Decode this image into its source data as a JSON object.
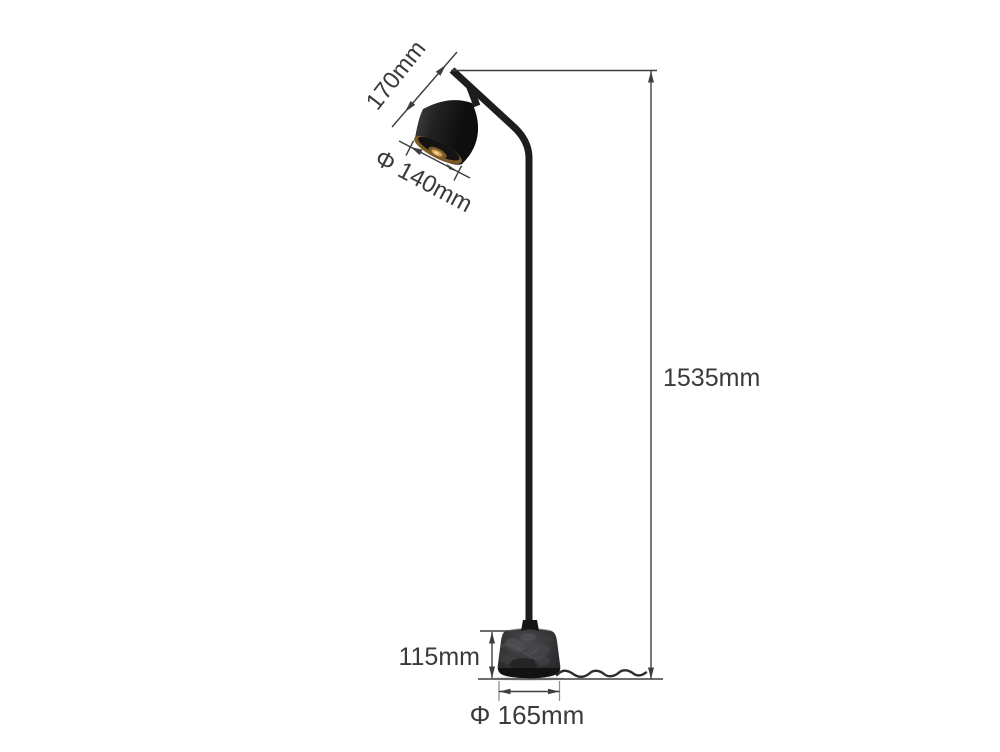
{
  "diagram": {
    "subject": "floor-lamp-dimension-diagram",
    "dimensions": {
      "head_height": {
        "label": "170mm"
      },
      "shade_diameter": {
        "label": "Φ 140mm"
      },
      "total_height": {
        "label": "1535mm"
      },
      "base_height": {
        "label": "115mm"
      },
      "base_diameter": {
        "label": "Φ 165mm"
      }
    },
    "colors": {
      "background": "#ffffff",
      "dimension_lines": "#3e3e3e",
      "label_text": "#3a3a3a",
      "lamp_black": "#1d1d1f",
      "shade_rim_gold": "#7c5a26",
      "bulb_glow": "#f2d496",
      "marble_base_dark": "#2a2a2c",
      "marble_base_light": "#4a4a4d"
    }
  }
}
